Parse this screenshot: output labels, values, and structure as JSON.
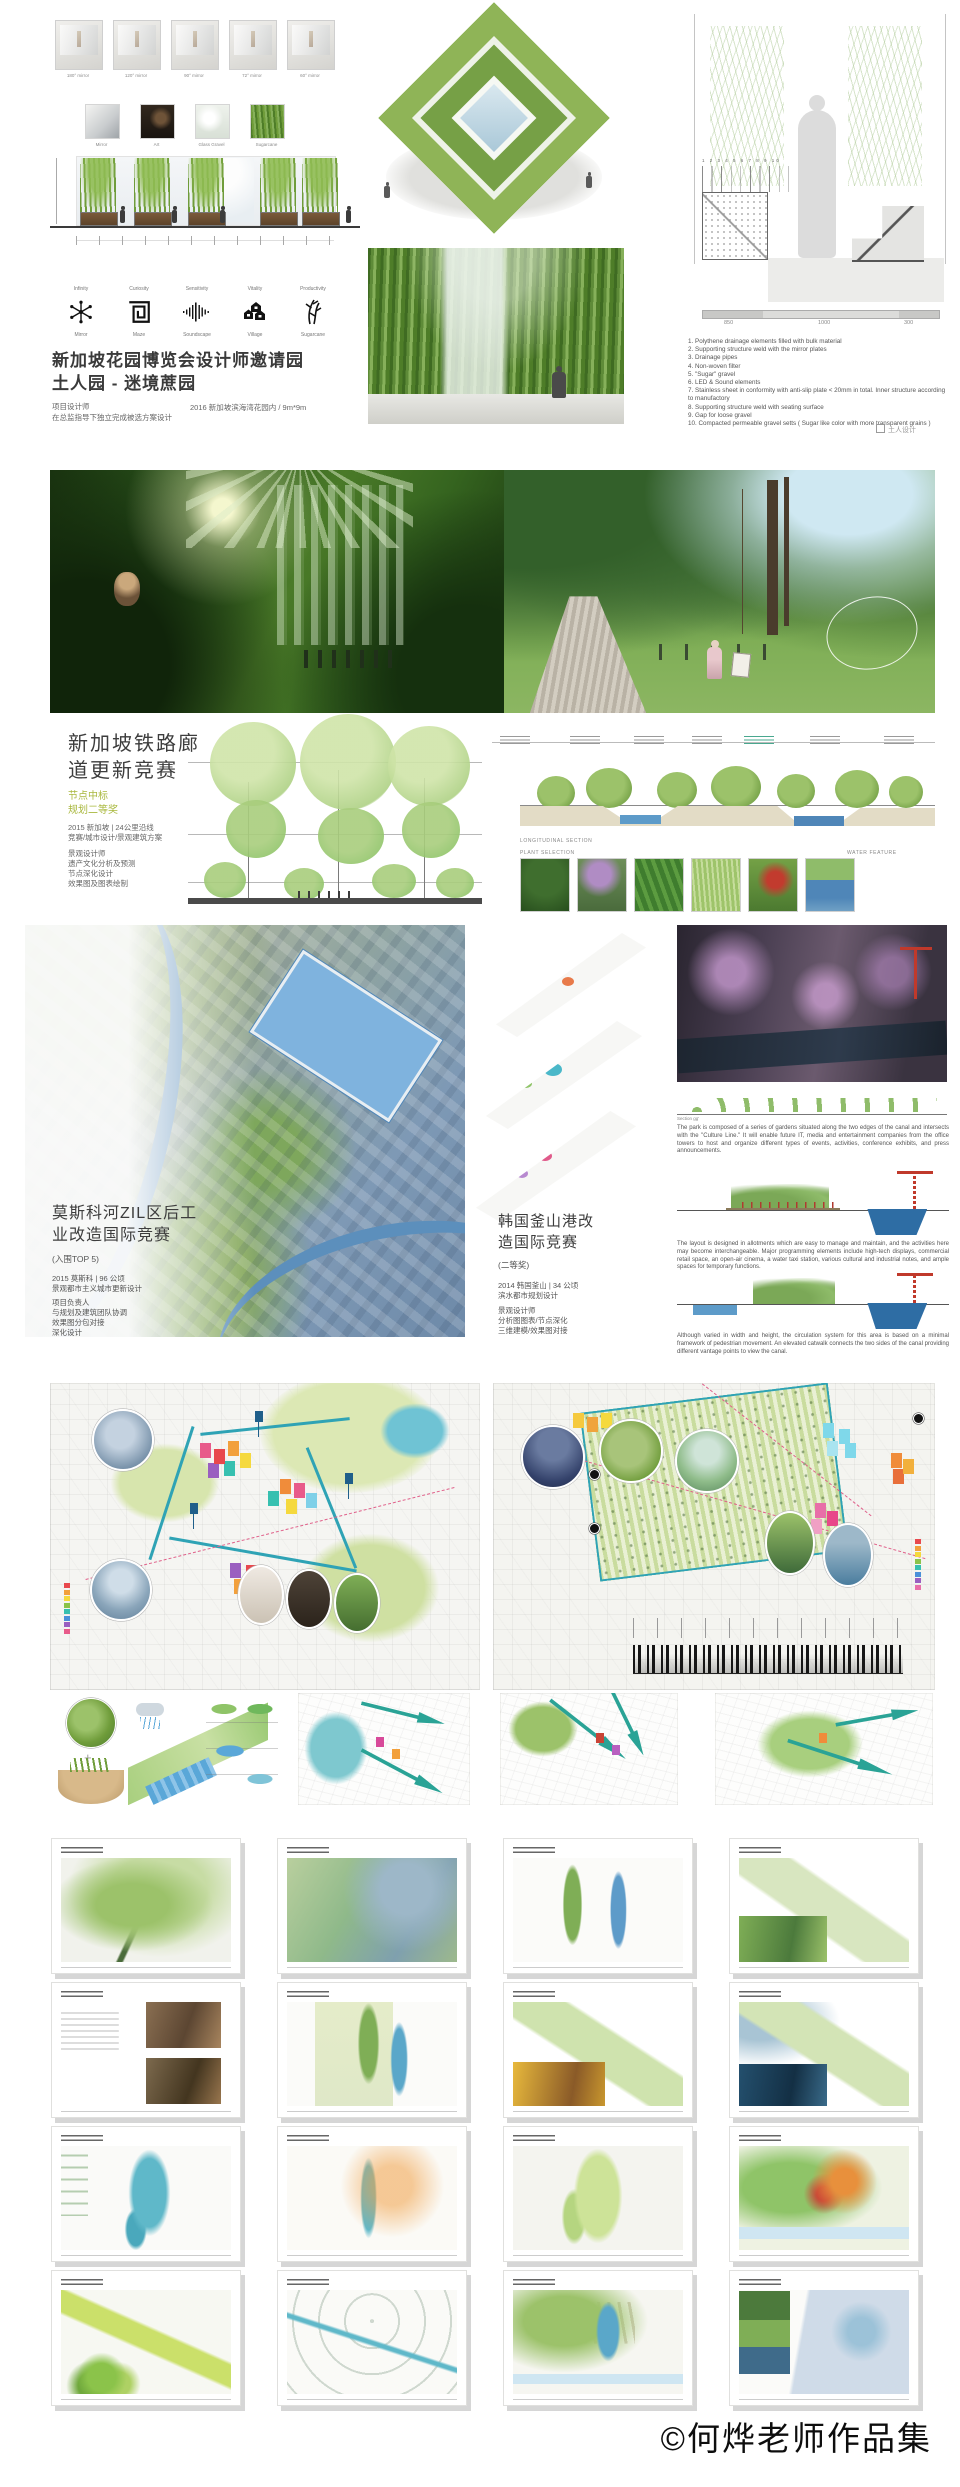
{
  "board1": {
    "mirror_studies": [
      "180° mirror",
      "120° mirror",
      "90° mirror",
      "72° mirror",
      "60° mirror"
    ],
    "materials": [
      "Mirror",
      "Art",
      "Glass Gravel",
      "Sugarcane"
    ],
    "concepts": [
      {
        "top": "Infinity",
        "bottom": "Mirror"
      },
      {
        "top": "Curiosity",
        "bottom": "Maze"
      },
      {
        "top": "Sensitivity",
        "bottom": "Soundscape"
      },
      {
        "top": "Vitality",
        "bottom": "Village"
      },
      {
        "top": "Productivity",
        "bottom": "Sugarcane"
      }
    ],
    "title_line1": "新加坡花园博览会设计师邀请园",
    "title_line2": "土人园 - 迷境蔗园",
    "credit_role": "项目设计师",
    "credit_desc": "在总监指导下独立完成被选方案设计",
    "meta": "2016 新加坡滨海湾花园内 / 9m*9m",
    "callouts": "1 2 3 4 5   6   7 8   9 10",
    "dimensions": [
      "850",
      "1000",
      "300"
    ],
    "annotations": [
      "1. Polythene drainage elements filled with bulk material",
      "2. Supporting structure weld with the mirror plates",
      "3. Drainage pipes",
      "4. Non-woven filter",
      "5. \"Sugar\" gravel",
      "6. LED & Sound elements",
      "7. Stainless sheet in conformity with anti-slip plate < 20mm in total. Inner structure according to manufactory",
      "8. Supporting structure weld with seating surface",
      "9. Gap for loose gravel",
      "10. Compacted permeable gravel setts ( Sugar like color with more transparent grains )"
    ],
    "logo": "土人设计"
  },
  "board2": {
    "title_line1": "新加坡铁路廊",
    "title_line2": "道更新竞赛",
    "award_line1": "节点中标",
    "award_line2": "规划二等奖",
    "meta_line1": "2015 新加坡 | 24公里沿线",
    "meta_line2": "竞赛/城市设计/景观建筑方案",
    "role_line1": "景观设计师",
    "role_line2": "遗产文化分析及预测",
    "role_line3": "节点深化设计",
    "role_line4": "效果图及图表绘制",
    "labels": {
      "long_section": "LONGITUDINAL SECTION",
      "plant_selection": "PLANT SELECTION",
      "water_feature": "WATER FEATURE"
    }
  },
  "board3": {
    "moscow": {
      "title_line1": "莫斯科河ZIL区后工",
      "title_line2": "业改造国际竞赛",
      "award": "(入围TOP 5)",
      "meta_line1": "2015 莫斯科 | 96 公顷",
      "meta_line2": "景观都市主义城市更新设计",
      "role_line1": "项目负责人",
      "role_line2": "与规划及建筑团队协调",
      "role_line3": "效果图分包对接",
      "role_line4": "深化设计"
    },
    "busan": {
      "title_line1": "韩国釜山港改",
      "title_line2": "造国际竞赛",
      "award": "(二等奖)",
      "meta_line1": "2014 韩国釜山 | 34 公顷",
      "meta_line2": "滨水都市规划设计",
      "role_line1": "景观设计师",
      "role_line2": "分析图图表/节点深化",
      "role_line3": "三维建模/效果图对接"
    },
    "section_label": "Section gg'",
    "paragraphs": [
      "The park is composed of a series of gardens situated along the two edges of the canal and intersects with the \"Culture Line.\" It will enable future IT, media and entertainment companies from the office towers to host and organize different types of events, activities, conference exhibits, and press announcements.",
      "The layout is designed in allotments which are easy to manage and maintain, and the activities here may become interchangeable. Major programming elements include high-tech displays, commercial retail space, an open-air cinema, a water taxi station, various cultural and industrial notes, and ample spaces for temporary functions.",
      "Although varied in width and height, the circulation system for this area is based on a minimal framework of pedestrian movement. An elevated catwalk connects the two sides of the canal providing different vantage points to view the canal."
    ]
  },
  "grid": {
    "cells": [
      {
        "variant": "v1"
      },
      {
        "variant": "v2"
      },
      {
        "variant": "v3"
      },
      {
        "variant": "v4"
      },
      {
        "variant": "v5"
      },
      {
        "variant": "v6"
      },
      {
        "variant": "v7"
      },
      {
        "variant": "v8"
      },
      {
        "variant": "v9"
      },
      {
        "variant": "v10"
      },
      {
        "variant": "v11"
      },
      {
        "variant": "v12"
      },
      {
        "variant": "v13"
      },
      {
        "variant": "v14"
      },
      {
        "variant": "v15"
      },
      {
        "variant": "v16"
      }
    ]
  },
  "copyright": "©何烨老师作品集"
}
